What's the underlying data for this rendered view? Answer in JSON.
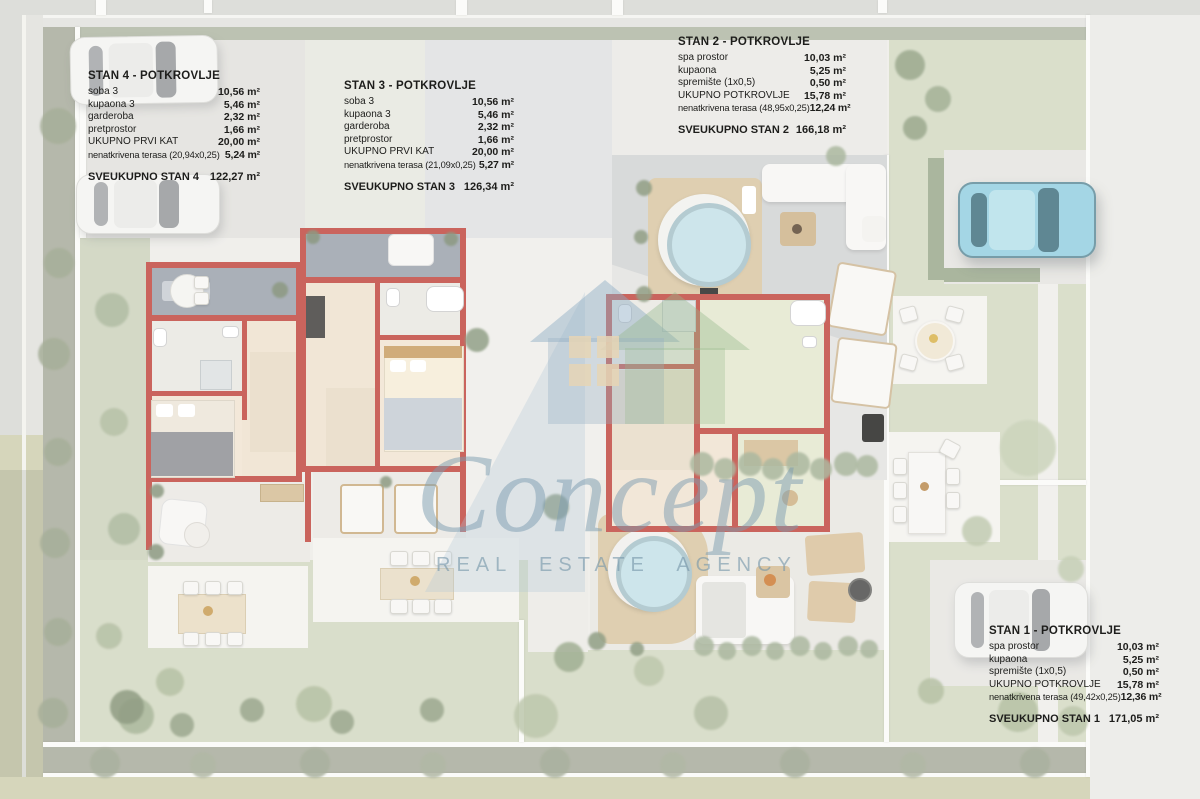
{
  "watermark": {
    "brand": "Concept",
    "subtitle": "REAL ESTATE AGENCY"
  },
  "units": [
    {
      "id": "stan4",
      "title": "STAN 4 - POTKROVLJE",
      "rows": [
        {
          "label": "soba 3",
          "value": "10,56 m²"
        },
        {
          "label": "kupaona 3",
          "value": "5,46 m²"
        },
        {
          "label": "garderoba",
          "value": "2,32 m²"
        },
        {
          "label": "pretprostor",
          "value": "1,66 m²"
        },
        {
          "label": "UKUPNO PRVI KAT",
          "value": "20,00 m²"
        },
        {
          "label": "nenatkrivena terasa  (20,94x0,25)",
          "value": "5,24 m²"
        }
      ],
      "total": {
        "label": "SVEUKUPNO STAN 4",
        "value": "122,27 m²"
      }
    },
    {
      "id": "stan3",
      "title": "STAN 3 - POTKROVLJE",
      "rows": [
        {
          "label": "soba 3",
          "value": "10,56 m²"
        },
        {
          "label": "kupaona 3",
          "value": "5,46 m²"
        },
        {
          "label": "garderoba",
          "value": "2,32 m²"
        },
        {
          "label": "pretprostor",
          "value": "1,66 m²"
        },
        {
          "label": "UKUPNO PRVI KAT",
          "value": "20,00 m²"
        },
        {
          "label": "nenatkrivena terasa  (21,09x0,25)",
          "value": "5,27 m²"
        }
      ],
      "total": {
        "label": "SVEUKUPNO STAN 3",
        "value": "126,34 m²"
      }
    },
    {
      "id": "stan2",
      "title": "STAN 2 - POTKROVLJE",
      "rows": [
        {
          "label": "spa prostor",
          "value": "10,03 m²"
        },
        {
          "label": "kupaona",
          "value": "5,25 m²"
        },
        {
          "label": "spremište (1x0,5)",
          "value": "0,50 m²"
        },
        {
          "label": "UKUPNO POTKROVLJE",
          "value": "15,78 m²"
        },
        {
          "label": "nenatkrivena terasa  (48,95x0,25)",
          "value": "12,24 m²"
        }
      ],
      "total": {
        "label": "SVEUKUPNO STAN 2",
        "value": "166,18 m²"
      }
    },
    {
      "id": "stan1",
      "title": "STAN 1 - POTKROVLJE",
      "rows": [
        {
          "label": "spa prostor",
          "value": "10,03 m²"
        },
        {
          "label": "kupaona",
          "value": "5,25 m²"
        },
        {
          "label": "spremište (1x0,5)",
          "value": "0,50 m²"
        },
        {
          "label": "UKUPNO POTKROVLJE",
          "value": "15,78 m²"
        },
        {
          "label": "nenatkrivena terasa  (49,42x0,25)",
          "value": "12,36 m²"
        }
      ],
      "total": {
        "label": "SVEUKUPNO STAN 1",
        "value": "171,05 m²"
      }
    }
  ]
}
